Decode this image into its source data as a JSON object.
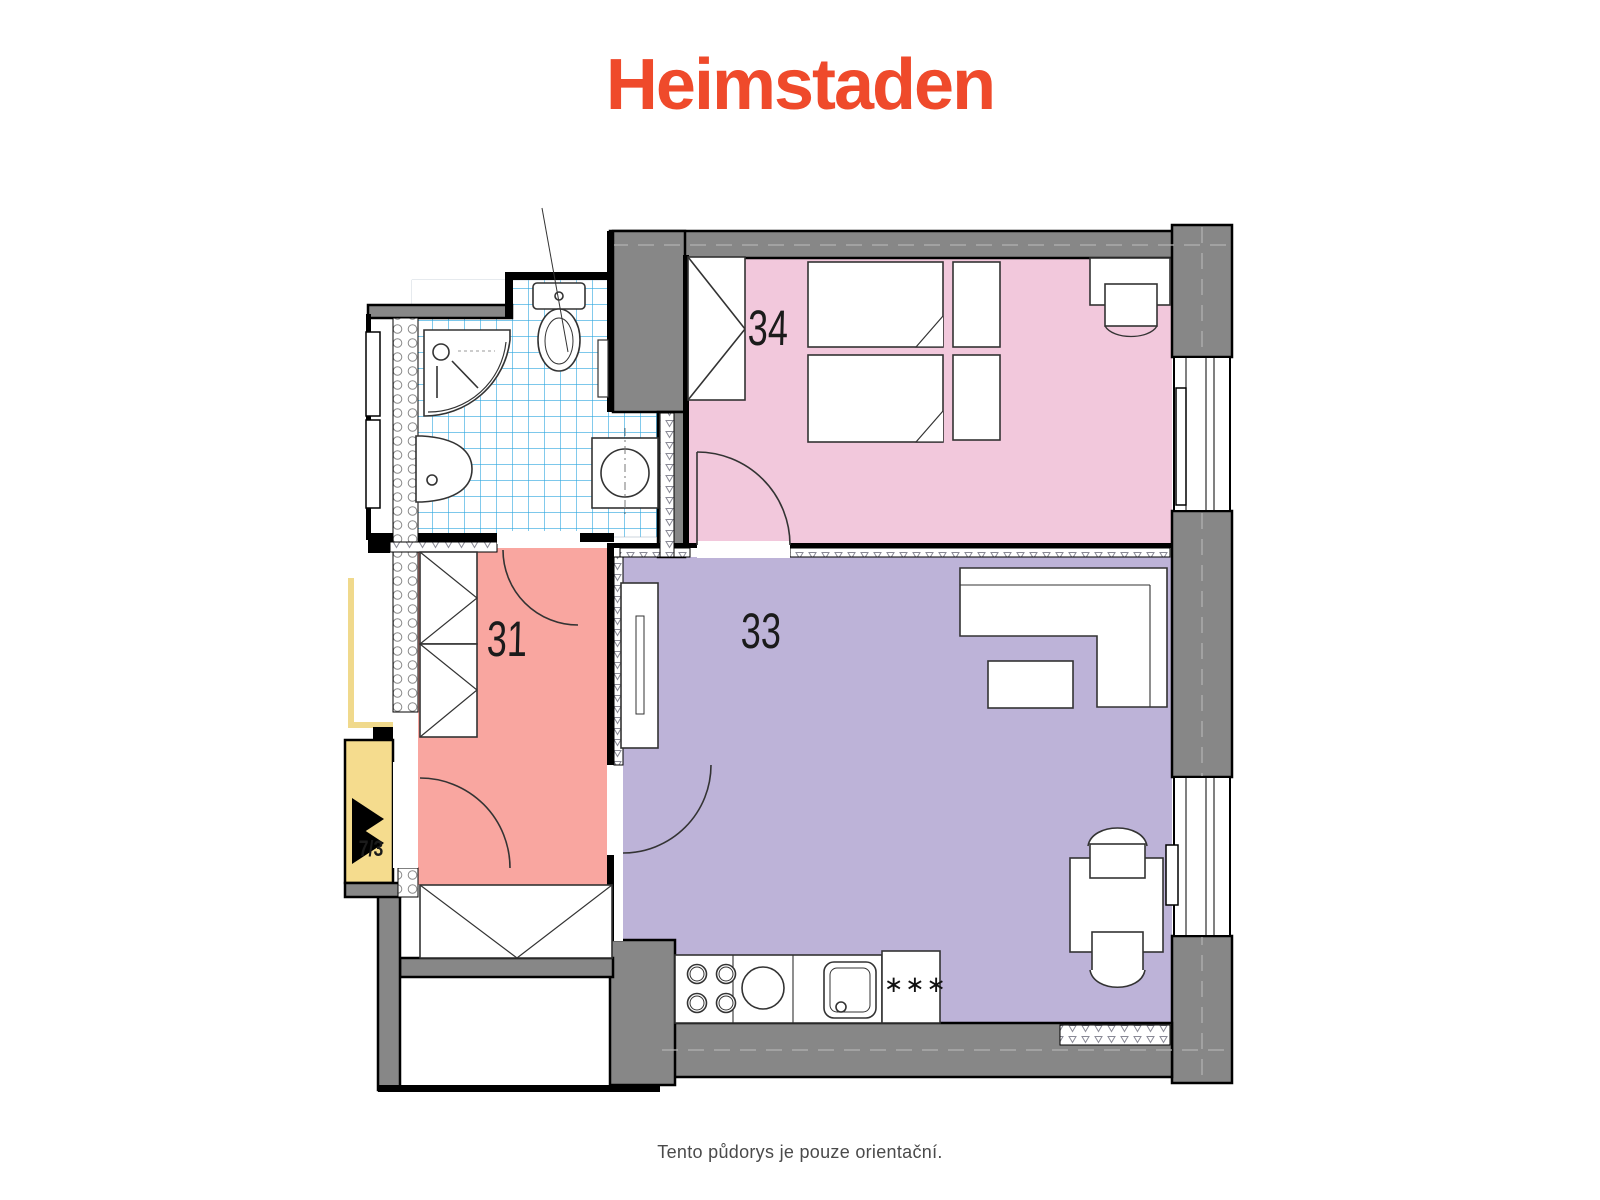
{
  "header": {
    "logo_text": "Heimstaden",
    "logo_color": "#EF4A2B"
  },
  "footer": {
    "disclaimer": "Tento půdorys je pouze orientační."
  },
  "floor_plan": {
    "rooms": [
      {
        "id": "34",
        "label": "34",
        "name": "bedroom",
        "color": "#F2C8DC"
      },
      {
        "id": "33",
        "label": "33",
        "name": "living-room-kitchen",
        "color": "#BDB3D8"
      },
      {
        "id": "31",
        "label": "31",
        "name": "hallway",
        "color": "#F9A6A0"
      },
      {
        "id": "7/3",
        "label": "7/3",
        "name": "staircase-landing",
        "color": "#F5DC8E"
      }
    ],
    "unit_label": "7/3",
    "fridge_symbol": "∗∗∗",
    "wall_color": "#878787",
    "bathroom_tile_color": "#2FA7DF"
  }
}
